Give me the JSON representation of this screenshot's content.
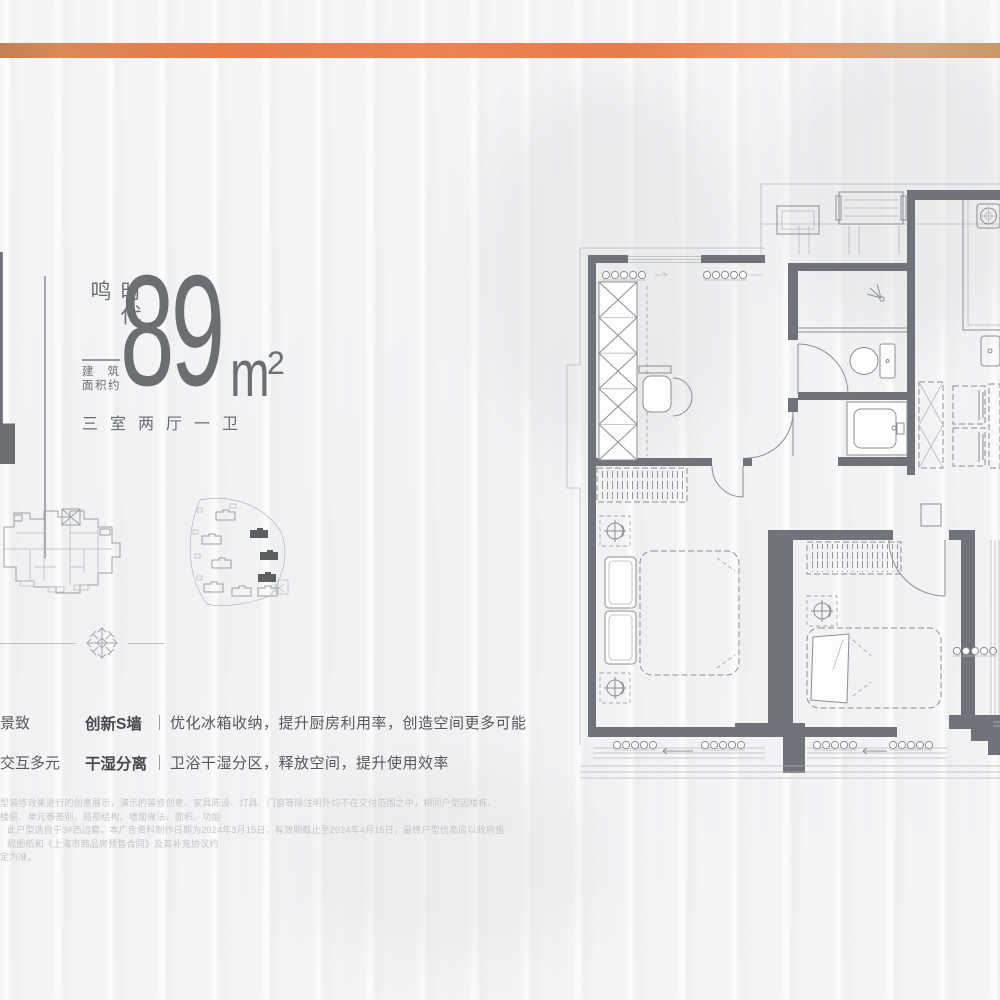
{
  "page": {
    "background": "#f4f4f6"
  },
  "top_bar": {
    "gradient_colors": [
      "#c08055",
      "#e87a48",
      "#ec8352",
      "#cfa07a"
    ]
  },
  "unit_info": {
    "big_number": "1",
    "series_name": "时代·鸣",
    "area_caption_line1": "建筑",
    "area_caption_line2": "面积约",
    "area_value": "89",
    "area_unit": "m",
    "area_superscript": "2",
    "layout_text": "三室两厅一卫"
  },
  "features": {
    "tags": [
      {
        "label": "景致"
      },
      {
        "label": "交互多元"
      }
    ],
    "rows": [
      {
        "title": "创新S墙",
        "separator": "｜",
        "description": "优化冰箱收纳，提升厨房利用率，创造空间更多可能"
      },
      {
        "title": "干湿分离",
        "separator": "｜",
        "description": "卫浴干湿分区，释放空间，提升使用效率"
      }
    ]
  },
  "disclaimer": {
    "line1": "型装修效果进行的创意展示，演示的装修创意、家具陈设、灯具、门窗等除注明外均不在交付范围之中，相同户型因楼栋、楼层、单元等差别，局部结构、墙面做法、面积、功能",
    "line2": "此户型选自于3#西边套。本广告资料制作日期为2024年3月15日，有效期截止至2024年4月15日，最终户型信息应以政府报规图纸和《上海市商品房预售合同》及其补充协议约",
    "line3": "定为准。"
  },
  "plan": {
    "wall_color": "#70747a",
    "line_color": "#8b8e92",
    "rooms": "三室两厅一卫"
  }
}
